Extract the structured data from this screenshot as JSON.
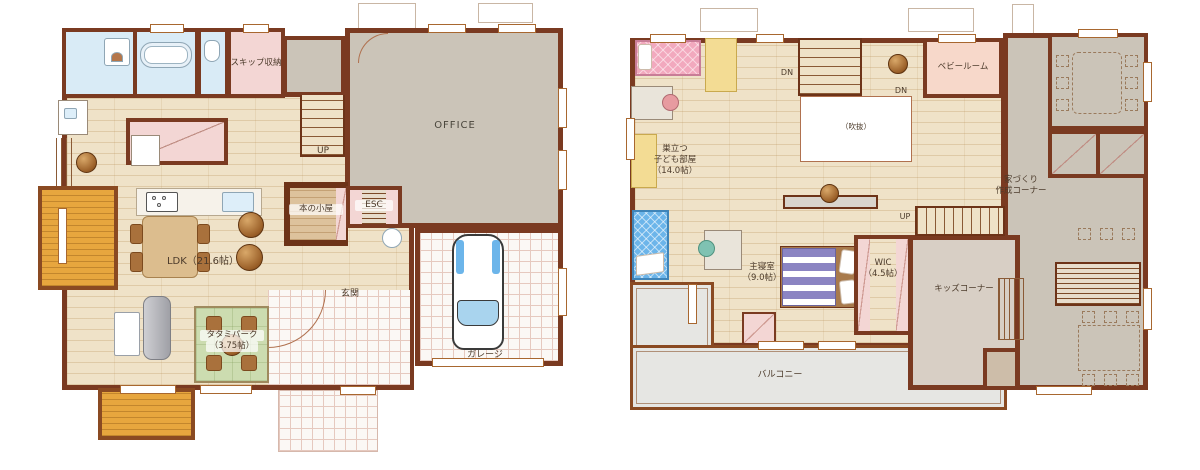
{
  "colors": {
    "wall": "#7a3a21",
    "wall-dark": "#6d3318",
    "wood": "#efe2c8",
    "gray-room": "#cbc4b8",
    "beige-room": "#d8cfc5",
    "pink-room": "#f3d6d4",
    "baby-pink": "#f7d8ca",
    "tatami-green": "#ccdcb0",
    "deck-orange": "#e7a63e",
    "balcony-gray": "#e6e6e3",
    "bath-blue": "#d9ebf6",
    "tile-line": "#e6c9bf",
    "bed-pink": "#f2a9be",
    "bed-blue": "#6cb5ea",
    "bed-purple": "#8b84c2",
    "furn-yellow": "#f3dc94",
    "text": "#4c3b2b"
  },
  "floor1": {
    "skip_storage": "スキップ収納",
    "office": "OFFICE",
    "up": "UP",
    "esc": "ESC",
    "book_hut": "本の小屋",
    "ldk": "LDK（21.6帖）",
    "genkan": "玄関",
    "garage": "ガレージ",
    "tatami_line1": "タタミパーク",
    "tatami_line2": "（3.75帖）"
  },
  "floor2": {
    "kids_room_line1": "巣立つ",
    "kids_room_line2": "子ども部屋",
    "kids_room_line3": "（14.0帖）",
    "dn_left": "DN",
    "dn_right": "DN",
    "void": "（吹抜）",
    "baby_room": "ベビールーム",
    "making_line1": "家づくり",
    "making_line2": "作成コーナー",
    "up": "UP",
    "master_line1": "主寝室",
    "master_line2": "（9.0帖）",
    "wic_line1": "WIC",
    "wic_line2": "（4.5帖）",
    "kids_corner": "キッズコーナー",
    "balcony": "バルコニー"
  }
}
